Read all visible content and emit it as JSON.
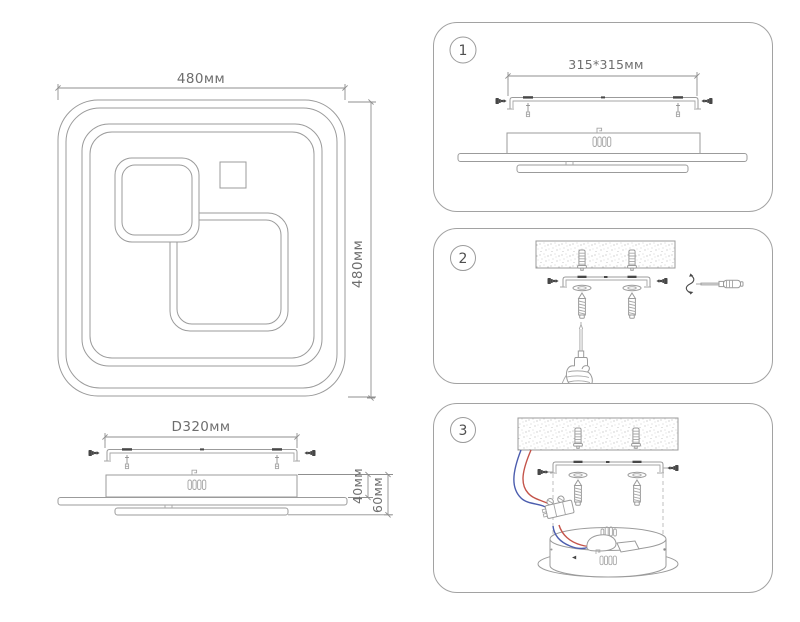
{
  "product": {
    "top_view": {
      "width": "480мм",
      "height": "480мм"
    },
    "side_view": {
      "mount_spacing": "D320мм",
      "body_height": "40мм",
      "total_height": "60мм"
    }
  },
  "steps": [
    {
      "number": "1",
      "plate_size": "315*315мм"
    },
    {
      "number": "2"
    },
    {
      "number": "3"
    }
  ],
  "colors": {
    "line": "#9b9b9b",
    "dark_part": "#474747",
    "text": "#6e6e6e",
    "wire_red": "#c4544a",
    "wire_blue": "#4c5dae"
  }
}
